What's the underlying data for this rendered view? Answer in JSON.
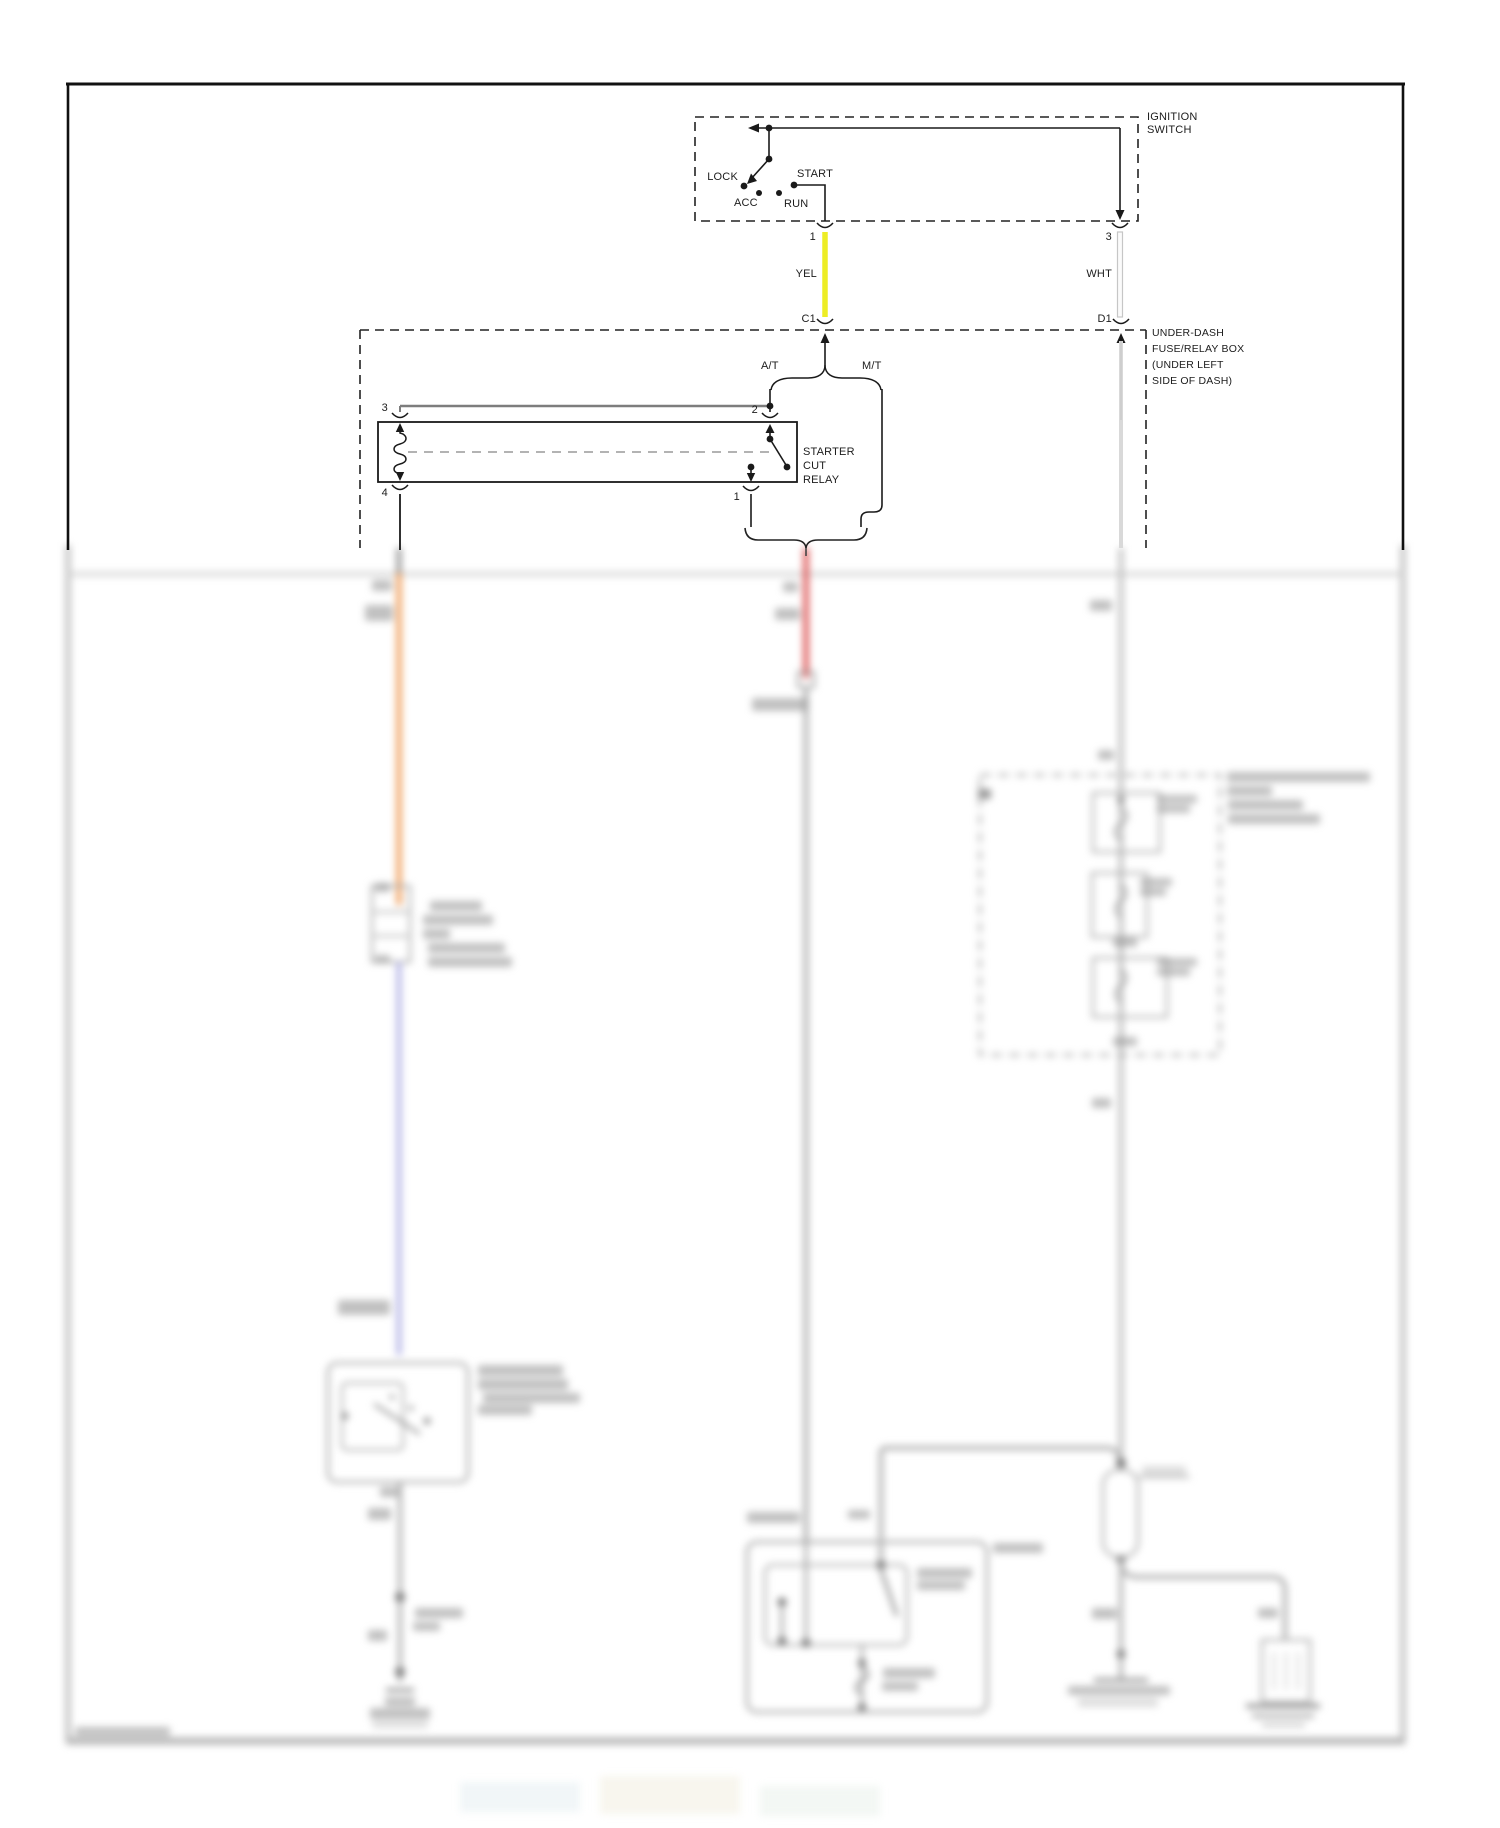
{
  "title": "Starting system wiring diagram (top portion sharp, lower portion blurred preview)",
  "ignition_switch": {
    "label": [
      "IGNITION",
      "SWITCH"
    ],
    "positions": {
      "lock": "LOCK",
      "acc": "ACC",
      "run": "RUN",
      "start": "START"
    },
    "pin_1": "1",
    "pin_3": "3"
  },
  "wires": {
    "yellow_label": "YEL",
    "white_label": "WHT"
  },
  "connectors": {
    "c1": "C1",
    "d1": "D1"
  },
  "under_dash_box": {
    "label": [
      "UNDER-DASH",
      "FUSE/RELAY BOX",
      "(UNDER LEFT",
      "SIDE OF DASH)"
    ]
  },
  "branches": {
    "at": "A/T",
    "mt": "M/T"
  },
  "starter_cut_relay": {
    "label": [
      "STARTER",
      "CUT",
      "RELAY"
    ],
    "pin_3": "3",
    "pin_2": "2",
    "pin_4": "4",
    "pin_1": "1"
  },
  "colors": {
    "line_black": "#1a1a1a",
    "yellow_wire": "#eded25",
    "white_wire": "#f7f7f7",
    "orange_wire": "#f0a364",
    "blue_wire": "#b9b9e8",
    "red_wire": "#dd5858",
    "gray_wire": "#b3b3b3",
    "border_blur": "#bdbdbd"
  }
}
